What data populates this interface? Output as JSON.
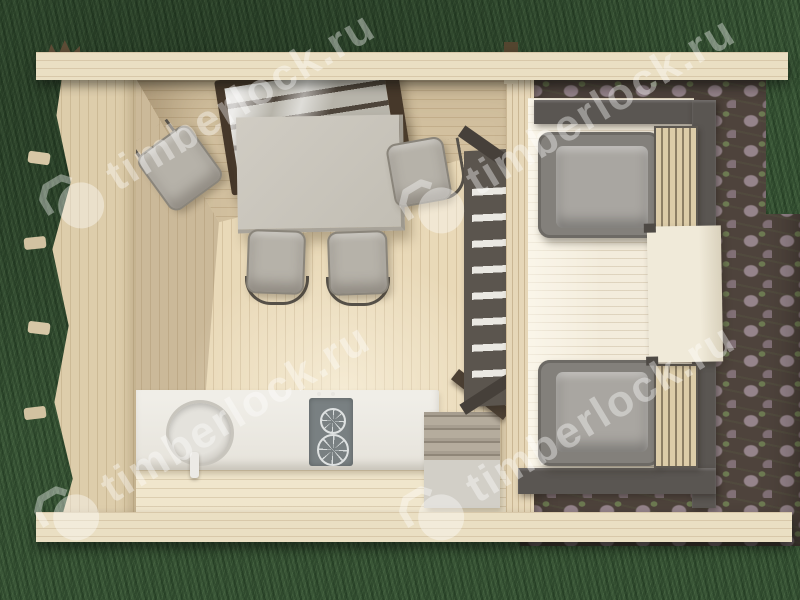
{
  "image": {
    "type": "3d-render-top-down-view",
    "subject": "wooden garden cabin cutaway floor plan with furnished room, covered terrace, cobblestone patio and lawn"
  },
  "watermark": {
    "text": "timberlock.ru",
    "icon": "padlock-icon",
    "color": "#ffffff",
    "opacity": 0.38,
    "rotation_deg": -31,
    "instances": 4
  },
  "palette": {
    "grass_green": "#3a5637",
    "cobblestone_gray": "#8d7b82",
    "cobble_gap": "#4e433c",
    "wood_eave_light": "#eadfc3",
    "wood_wall": "#d2c09f",
    "wood_floor": "#e9d9b8",
    "terrace_floor": "#f3ecdc",
    "frame_dark_gray": "#5a5652",
    "window_frame_brown": "#46382a",
    "table_gray": "#c9c5bc",
    "cushion_gray": "#a9a6a1",
    "counter_white": "#edebe4",
    "stove_gray": "#798082"
  },
  "objects": [
    "log cabin seen from above with roof removed",
    "opened tilt window on back wall",
    "dining table with four chairs",
    "kitchen counter with round sink, faucet and two-burner stove",
    "storage step bench",
    "tall wall shelf rack",
    "covered terrace with dark pergola frame",
    "two gray armchairs with slatted side benches",
    "terrace side table",
    "cobblestone patio",
    "lawn"
  ]
}
